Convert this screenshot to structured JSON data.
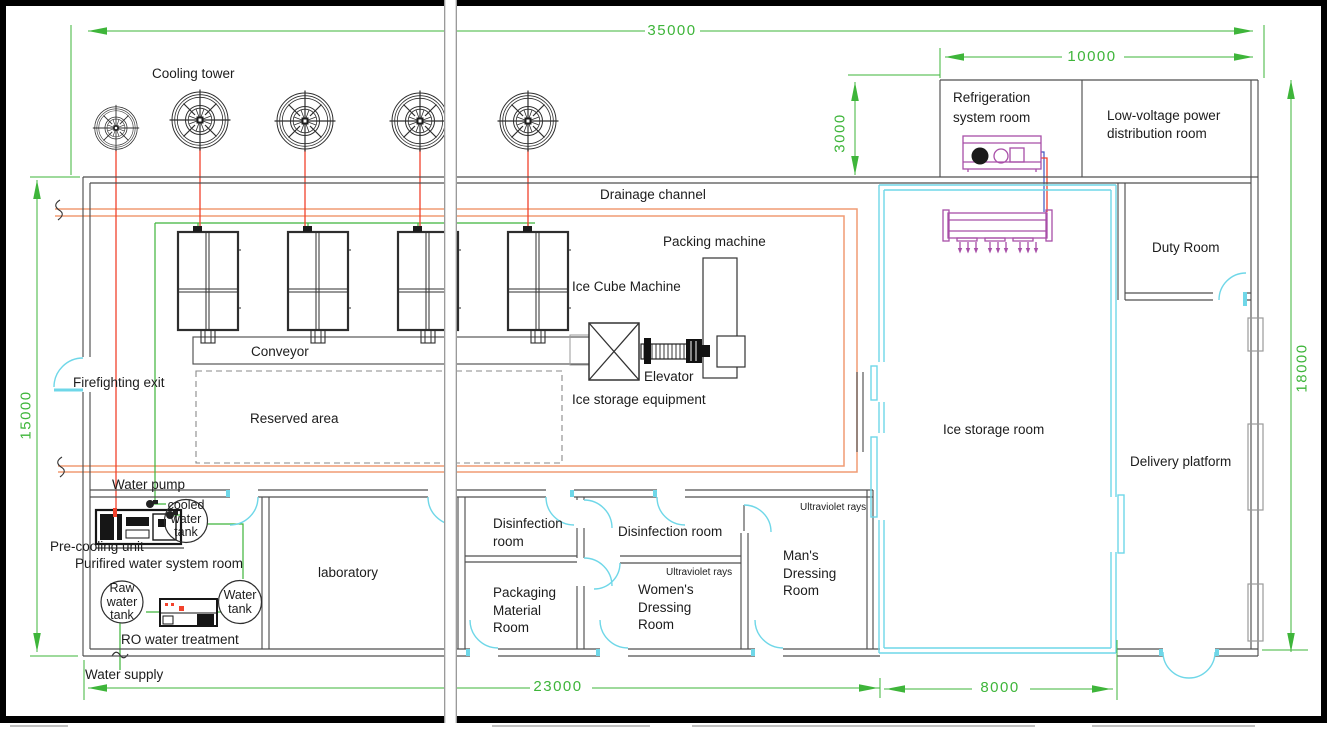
{
  "colors": {
    "green": "#3eb53a",
    "red": "#f2422c",
    "orange": "#f09b74",
    "cyan": "#6fd7e8",
    "purple": "#a84fa8",
    "wall": "#4f4f4f"
  },
  "dims": {
    "w35000": "35000",
    "w10000": "10000",
    "h3000": "3000",
    "h15000": "15000",
    "h18000": "18000",
    "w23000": "23000",
    "w8000": "8000"
  },
  "labels": {
    "cooling_tower": "Cooling tower",
    "drainage_channel": "Drainage channel",
    "packing_machine": "Packing machine",
    "ice_cube_machine": "Ice Cube Machine",
    "conveyor": "Conveyor",
    "elevator": "Elevator",
    "ice_storage_equipment": "Ice storage equipment",
    "reserved_area": "Reserved area",
    "firefighting_exit": "Firefighting exit",
    "water_pump": "Water pump",
    "pre_cooling_unit": "Pre-cooling unit",
    "purified_room": "Purifired water system room",
    "ro_water_treatment": "RO water treatment",
    "water_supply": "Water supply",
    "laboratory": "laboratory",
    "disinfection_room_2": "Disinfection room",
    "ice_storage_room": "Ice storage room",
    "delivery_platform": "Delivery platform",
    "duty_room": "Duty Room",
    "uv_rays_mens": "Ultraviolet rays",
    "uv_rays_womens": "Ultraviolet rays"
  },
  "multiline": {
    "refrigeration_room": [
      "Refrigeration",
      "system room"
    ],
    "low_voltage_room": [
      "Low-voltage power",
      "distribution room"
    ],
    "disinfection_room_1": [
      "Disinfection",
      "room"
    ],
    "packaging_material_room": [
      "Packaging",
      "Material",
      "Room"
    ],
    "womens_dressing_room": [
      "Women's",
      "Dressing",
      "Room"
    ],
    "mans_dressing_room": [
      "Man's",
      "Dressing",
      "Room"
    ]
  },
  "tanks": {
    "cooled_water": [
      "cooled",
      "water",
      "tank"
    ],
    "raw_water": [
      "Raw",
      "water",
      "tank"
    ],
    "water_tank": [
      "Water",
      "tank"
    ]
  }
}
